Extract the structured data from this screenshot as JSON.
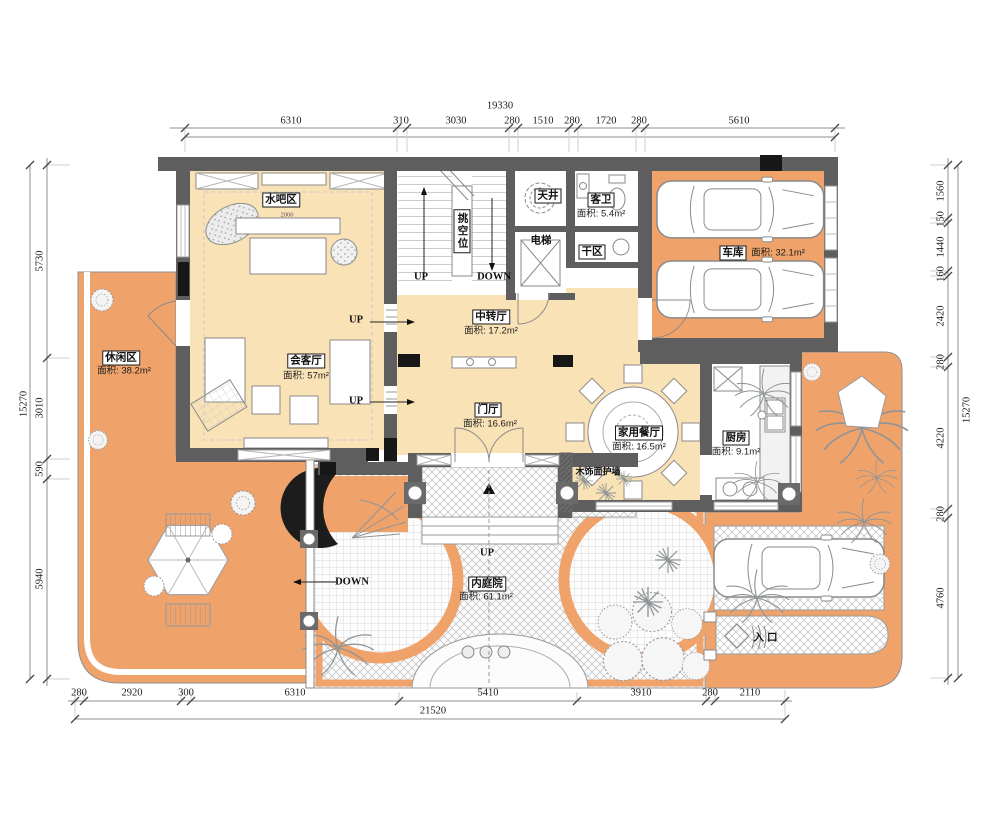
{
  "colors": {
    "wall": "#5e5e5e",
    "floor": "#f9e2b5",
    "terrace": "#f0a26b",
    "paper": "#ffffff"
  },
  "rooms": {
    "shuiba": {
      "name": "水吧区"
    },
    "huiketing": {
      "name": "会客厅",
      "area": "面积: 57m²"
    },
    "zhongzhuan": {
      "name": "中转厅",
      "area": "面积: 17.2m²"
    },
    "menting": {
      "name": "门厅",
      "area": "面积: 16.6m²"
    },
    "xiuxian": {
      "name": "休闲区",
      "area": "面积: 38.2m²"
    },
    "tianjing": {
      "name": "天井"
    },
    "kewei": {
      "name": "客卫",
      "area": "面积: 5.4m²"
    },
    "dianti": {
      "name": "电梯"
    },
    "ganqu": {
      "name": "干区"
    },
    "cheku": {
      "name": "车库",
      "area": "面积: 32.1m²"
    },
    "canting": {
      "name": "家用餐厅",
      "area": "面积: 16.5m²"
    },
    "chufang": {
      "name": "厨房",
      "area": "面积: 9.1m²"
    },
    "neitingyuan": {
      "name": "内庭院",
      "area": "面积: 61.1m²"
    }
  },
  "annotations": {
    "up": "UP",
    "down": "DOWN",
    "void_space": "挑空位",
    "wood_wall": "木饰面护墙",
    "entrance": "入口",
    "sofa_width": "2000"
  },
  "dimensions": {
    "top": {
      "total": "19330",
      "segments": [
        "6310",
        "310",
        "3030",
        "280",
        "1510",
        "280",
        "1720",
        "280",
        "5610"
      ]
    },
    "bottom": {
      "total": "21520",
      "segments": [
        "280",
        "2920",
        "300",
        "6310",
        "5410",
        "3910",
        "280",
        "2110"
      ]
    },
    "left": {
      "total": "15270",
      "segments": [
        "5730",
        "3010",
        "590",
        "5940"
      ]
    },
    "right": {
      "total": "15270",
      "segments": [
        "1560",
        "150",
        "1440",
        "160",
        "2420",
        "280",
        "4220",
        "280",
        "4760"
      ]
    }
  }
}
